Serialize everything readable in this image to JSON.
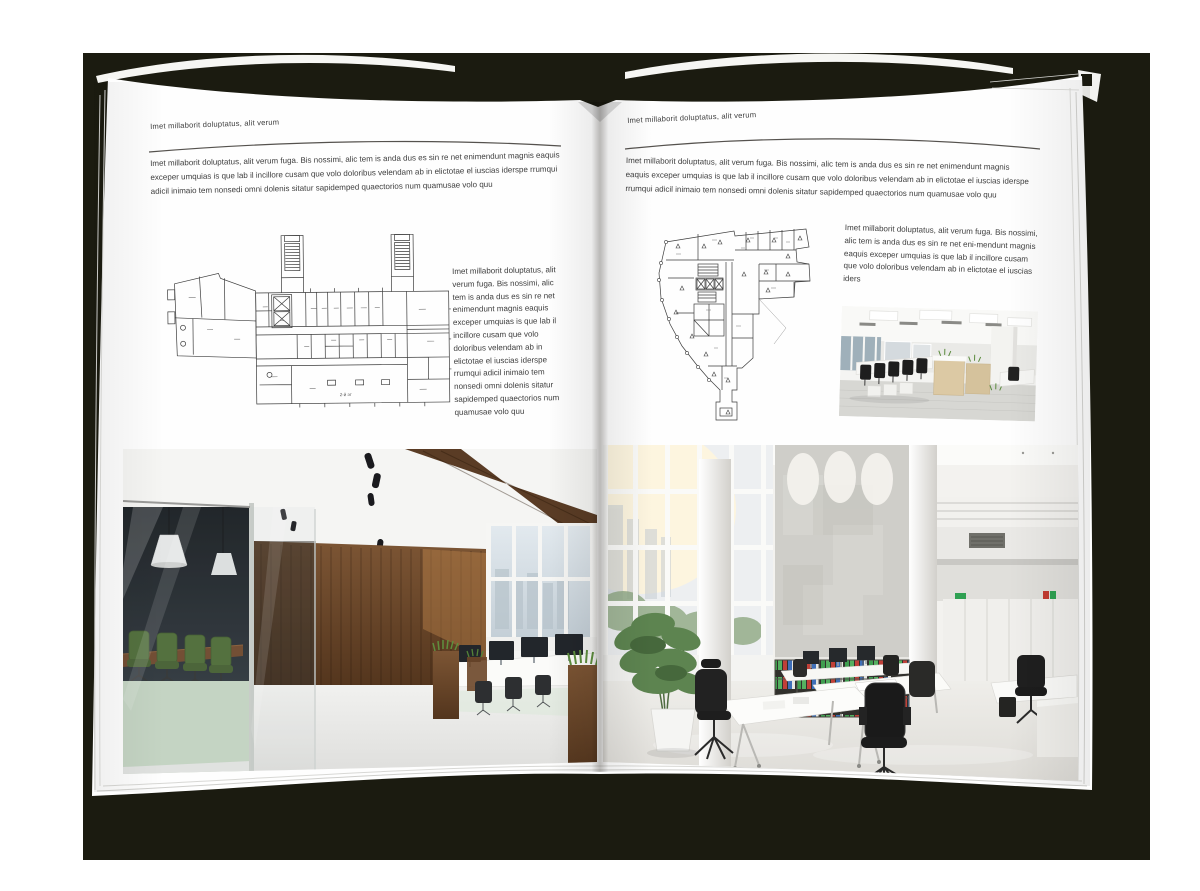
{
  "background": {
    "canvas_color": "#ffffff",
    "mat_color": "#1b1b10",
    "page_color": "#fefefe"
  },
  "left_page": {
    "header": "Imet millaborit doluptatus, alit verum",
    "intro_paragraph": "Imet millaborit doluptatus, alit verum fuga. Bis nossimi, alic tem is anda dus es sin re net enimendunt magnis eaquis exceper umquias is que lab il incillore cusam que volo doloribus velendam ab in elictotae el iuscias iderspe rrumqui adicil inimaio tem nonsedi omni dolenis sitatur sapidemped quaectorios num quamusae volo quu",
    "side_paragraph": "Imet millaborit doluptatus, alit verum fuga. Bis nossimi, alic tem is anda dus es sin re net enimendunt magnis eaquis exceper umquias is que lab il incillore cusam que volo doloribus velendam ab in elictotae el iuscias iderspe rrumqui adicil inimaio tem nonsedi omni dolenis sitatur sapidemped quaectorios num quamusae volo quu",
    "floor_plan_label": "2-й эт",
    "floor_plan": "wide-rectangular-building-plan-with-two-stair-towers",
    "photo": "loft-office-interior-with-glass-meeting-room-and-wood-wall"
  },
  "right_page": {
    "header": "Imet millaborit doluptatus, alit verum",
    "intro_paragraph": "Imet millaborit doluptatus, alit verum fuga. Bis nossimi, alic tem is anda dus es sin re net enimendunt magnis eaquis exceper umquias is que lab il incillore cusam que volo doloribus velendam ab in elictotae el iuscias iderspe rrumqui adicil inimaio tem nonsedi omni dolenis sitatur sapidemped quaectorios num quamusae volo quu",
    "side_paragraph": "Imet millaborit doluptatus, alit verum fuga. Bis nossimi, alic tem is anda dus es sin re net eni-mendunt magnis eaquis exceper umquias is que lab il incillore cusam que volo doloribus velendam ab in elictotae el iuscias iders",
    "floor_plan": "irregular-triangular-building-plan-with-bottom-stem",
    "photo_small": "open-plan-office-with-wooden-cabinets",
    "photo_large": "bright-double-height-office-with-window-wall-and-binder-shelves"
  },
  "illustration_colors": {
    "wood": "#6b4a2c",
    "meeting_chair_green": "#4c6a33",
    "plant_green": "#5d8450",
    "binder_green": "#3f9e4f",
    "binder_red": "#c04038",
    "binder_blue": "#3f6fb8"
  }
}
